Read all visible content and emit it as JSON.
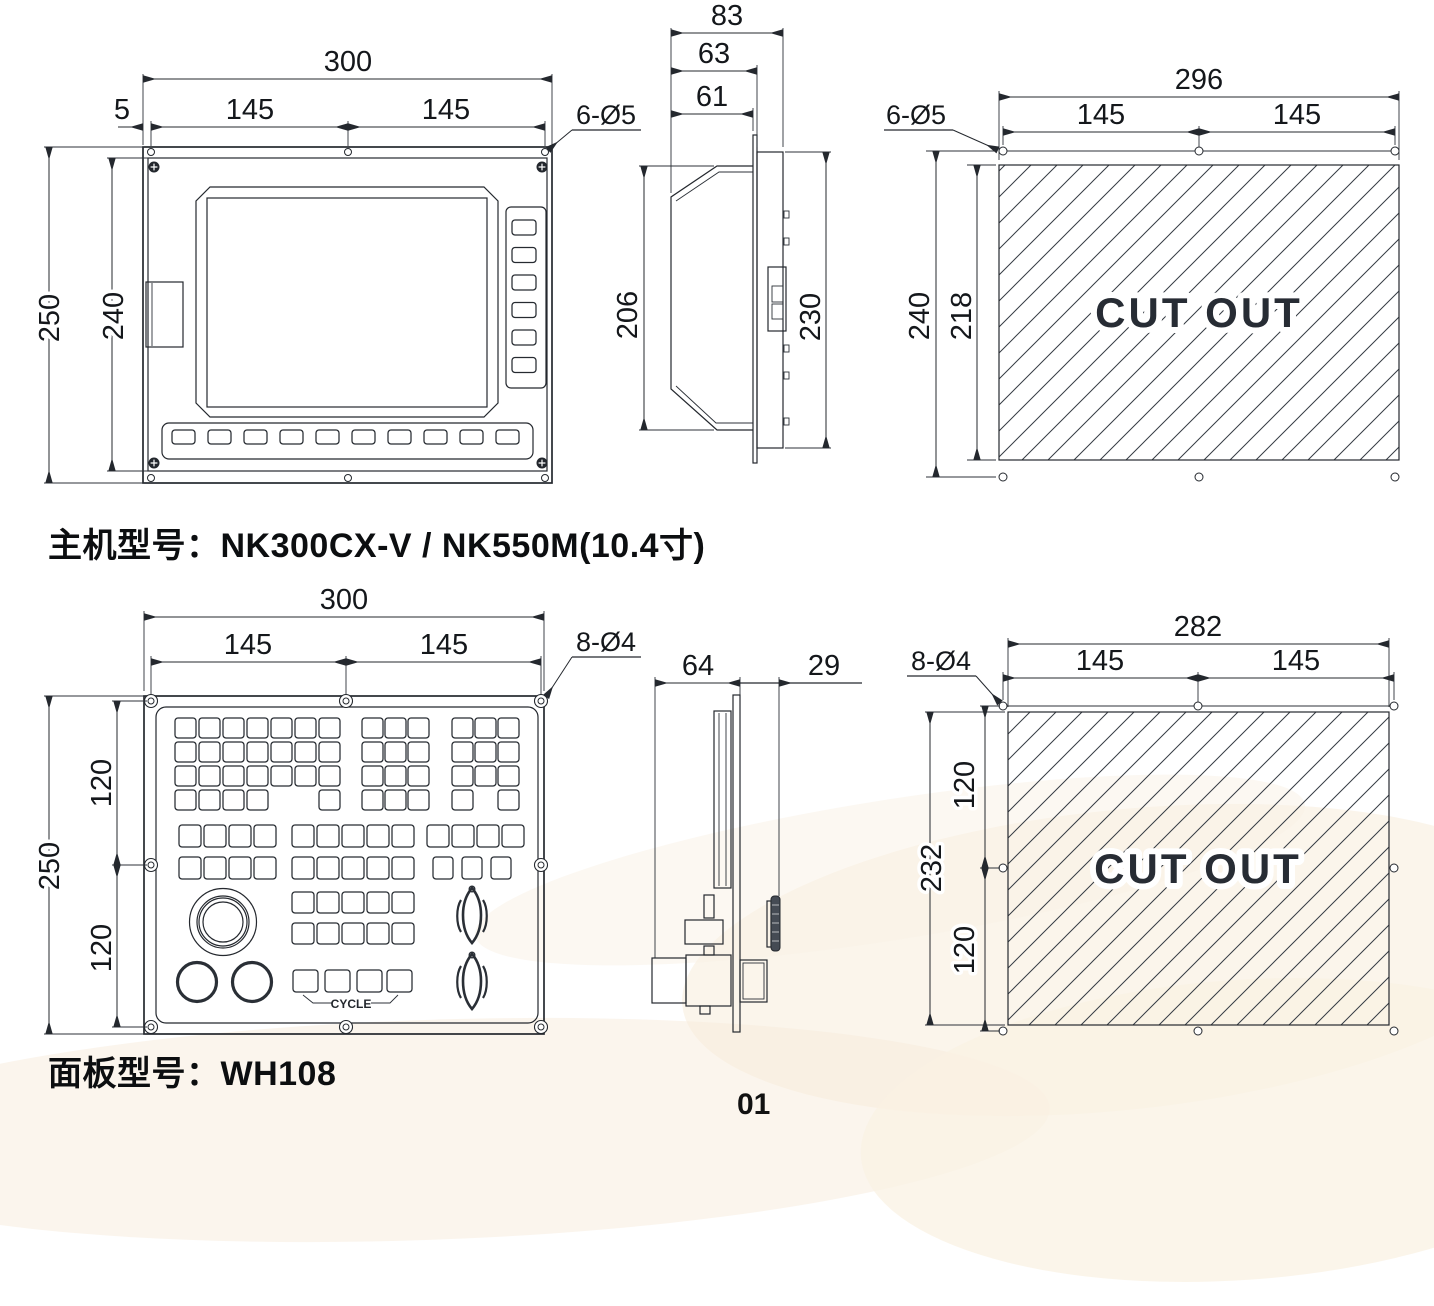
{
  "host": {
    "title_label": "主机型号：",
    "title_value": "NK300CX-V / NK550M(10.4寸)",
    "front": {
      "dim_width": "300",
      "dim_offset": "5",
      "dim_half_left": "145",
      "dim_half_right": "145",
      "dim_height": "250",
      "dim_inner_height": "240",
      "holes_label": "6-Ø5"
    },
    "side": {
      "dim_depth_total": "83",
      "dim_depth_body": "63",
      "dim_depth_inner": "61",
      "dim_body_height": "206",
      "dim_flange_height": "230"
    },
    "cutout": {
      "text": "CUT OUT",
      "dim_width": "296",
      "dim_half_left": "145",
      "dim_half_right": "145",
      "dim_height": "240",
      "dim_inner_height": "218",
      "holes_label": "6-Ø5"
    }
  },
  "panel": {
    "title_label": "面板型号：",
    "title_value": "WH108",
    "front": {
      "dim_width": "300",
      "dim_half_left": "145",
      "dim_half_right": "145",
      "dim_height": "250",
      "dim_seg_top": "120",
      "dim_seg_bottom": "120",
      "holes_label": "8-Ø4",
      "cycle_label": "CYCLE"
    },
    "side": {
      "dim_depth_rear": "64",
      "dim_depth_front": "29"
    },
    "cutout": {
      "text": "CUT OUT",
      "dim_width": "282",
      "dim_half_left": "145",
      "dim_half_right": "145",
      "dim_height": "232",
      "dim_seg_top": "120",
      "dim_seg_bottom": "120",
      "holes_label": "8-Ø4"
    }
  },
  "page": {
    "number": "01"
  }
}
